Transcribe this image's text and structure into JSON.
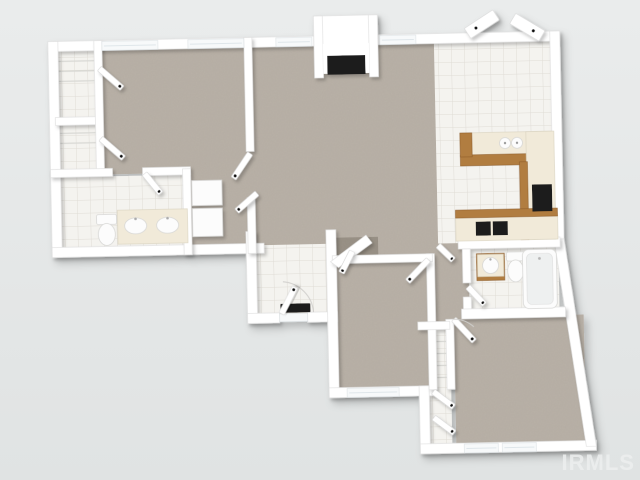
{
  "watermark": {
    "text": "IRMLS"
  },
  "colors": {
    "bg1": "#eaecec",
    "bg2": "#e0e3e3",
    "wall": "#ffffff",
    "wallshade": "#dedede",
    "carpet": "#b9b1a7",
    "carpetdark": "#958d82",
    "tile": "#f4f3ef",
    "tileline": "#dfdcd5",
    "wood": "#b17d3f",
    "woodark": "#8a5a26",
    "counter": "#f1ead9",
    "appliance": "#1a1a1a",
    "fixture": "#fcfcfc",
    "watermark": "#edefef"
  },
  "floorplan": {
    "view": "3d-top-down-dollhouse-render",
    "rooms": [
      {
        "name": "master-bedroom",
        "floor": "carpet"
      },
      {
        "name": "closet-upper",
        "floor": "tile"
      },
      {
        "name": "closet-lower",
        "floor": "tile"
      },
      {
        "name": "master-bathroom",
        "floor": "tile"
      },
      {
        "name": "dressing-area",
        "floor": "carpet"
      },
      {
        "name": "living-room",
        "floor": "carpet"
      },
      {
        "name": "dining-area",
        "floor": "tile"
      },
      {
        "name": "kitchen",
        "floor": "tile"
      },
      {
        "name": "entry-foyer",
        "floor": "tile"
      },
      {
        "name": "hallway",
        "floor": "carpet"
      },
      {
        "name": "hall-bathroom",
        "floor": "tile"
      },
      {
        "name": "bedroom-2",
        "floor": "carpet"
      },
      {
        "name": "bedroom-3",
        "floor": "carpet"
      },
      {
        "name": "bedroom-closet",
        "floor": "tile"
      }
    ],
    "fixtures": [
      "fireplace",
      "double-vanity-sinks",
      "toilet",
      "linen-shelves",
      "u-shaped-kitchen-cabinets",
      "wall-oven",
      "cooktop",
      "canisters",
      "vanity-sink",
      "bathtub",
      "door-mat",
      "windows",
      "french-doors",
      "door-leaves"
    ]
  }
}
